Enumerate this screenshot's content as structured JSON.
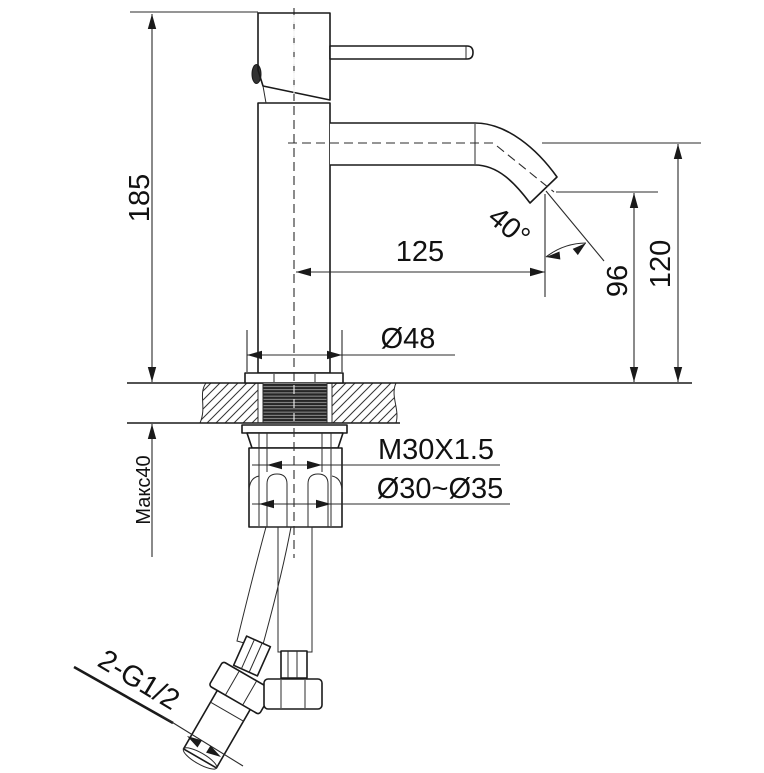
{
  "drawing": {
    "title": "single-lever-basin-faucet-installation-drawing",
    "colors": {
      "line": "#1a1a1a",
      "background": "#ffffff"
    },
    "labels": {
      "total_height": "185",
      "max_deck_thickness": "Макс40",
      "spout_reach": "125",
      "spout_angle": "40°",
      "outlet_height": "96",
      "spout_height": "120",
      "base_diameter": "Ø48",
      "mounting_thread": "M30X1.5",
      "mounting_hole_range": "Ø30~Ø35",
      "hose_connections": "2-G1/2"
    }
  }
}
